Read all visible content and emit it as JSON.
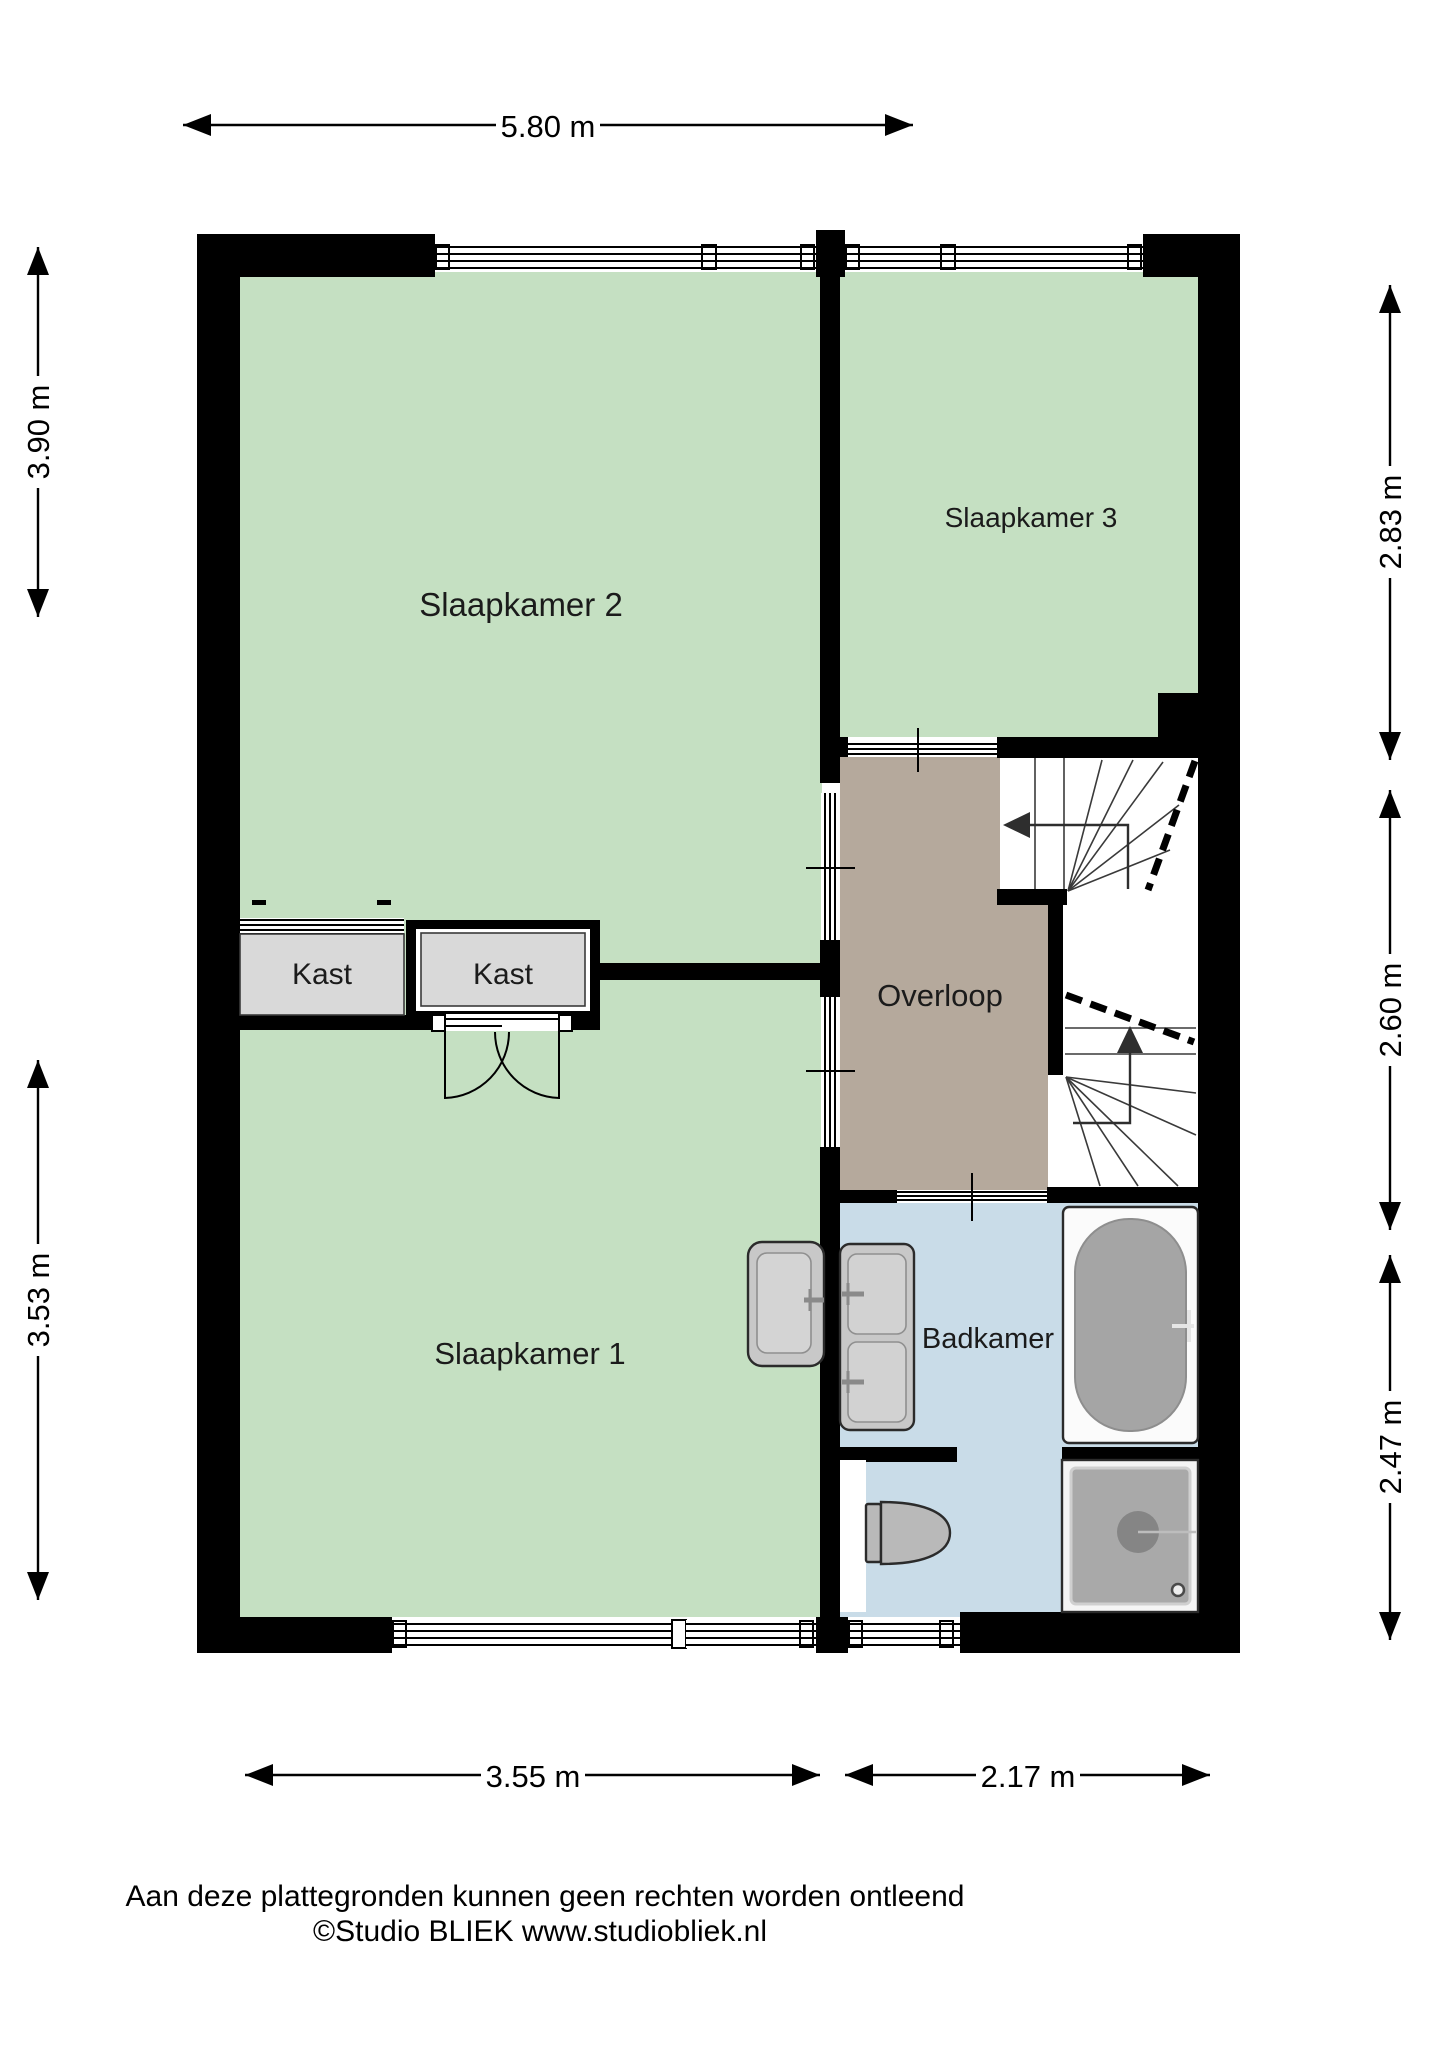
{
  "title": "Verdieping plattegrond",
  "rooms": {
    "slaapkamer2": {
      "label": "Slaapkamer 2"
    },
    "slaapkamer3": {
      "label": "Slaapkamer 3"
    },
    "slaapkamer1": {
      "label": "Slaapkamer 1"
    },
    "overloop": {
      "label": "Overloop"
    },
    "badkamer": {
      "label": "Badkamer"
    },
    "kast_left": {
      "label": "Kast"
    },
    "kast_right": {
      "label": "Kast"
    }
  },
  "dims": {
    "top": {
      "value": "5.80 m"
    },
    "left_upper": {
      "value": "3.90 m"
    },
    "left_lower": {
      "value": "3.53 m"
    },
    "right_upper": {
      "value": "2.83 m"
    },
    "right_middle": {
      "value": "2.60 m"
    },
    "right_lower": {
      "value": "2.47 m"
    },
    "bottom_left": {
      "value": "3.55 m"
    },
    "bottom_right": {
      "value": "2.17 m"
    }
  },
  "footer": {
    "line1": "Aan deze plattegronden kunnen geen rechten worden ontleend",
    "line2": "©Studio BLIEK www.studiobliek.nl"
  },
  "colors": {
    "wall_black": "#000000",
    "room_green": "#c5e0c2",
    "hall_brown": "#b5a99c",
    "bath_blue": "#c9dce8",
    "kast_grey": "#d9d9d9",
    "fixture_grey": "#c8c8c8",
    "tub_grey": "#a5a5a5"
  }
}
